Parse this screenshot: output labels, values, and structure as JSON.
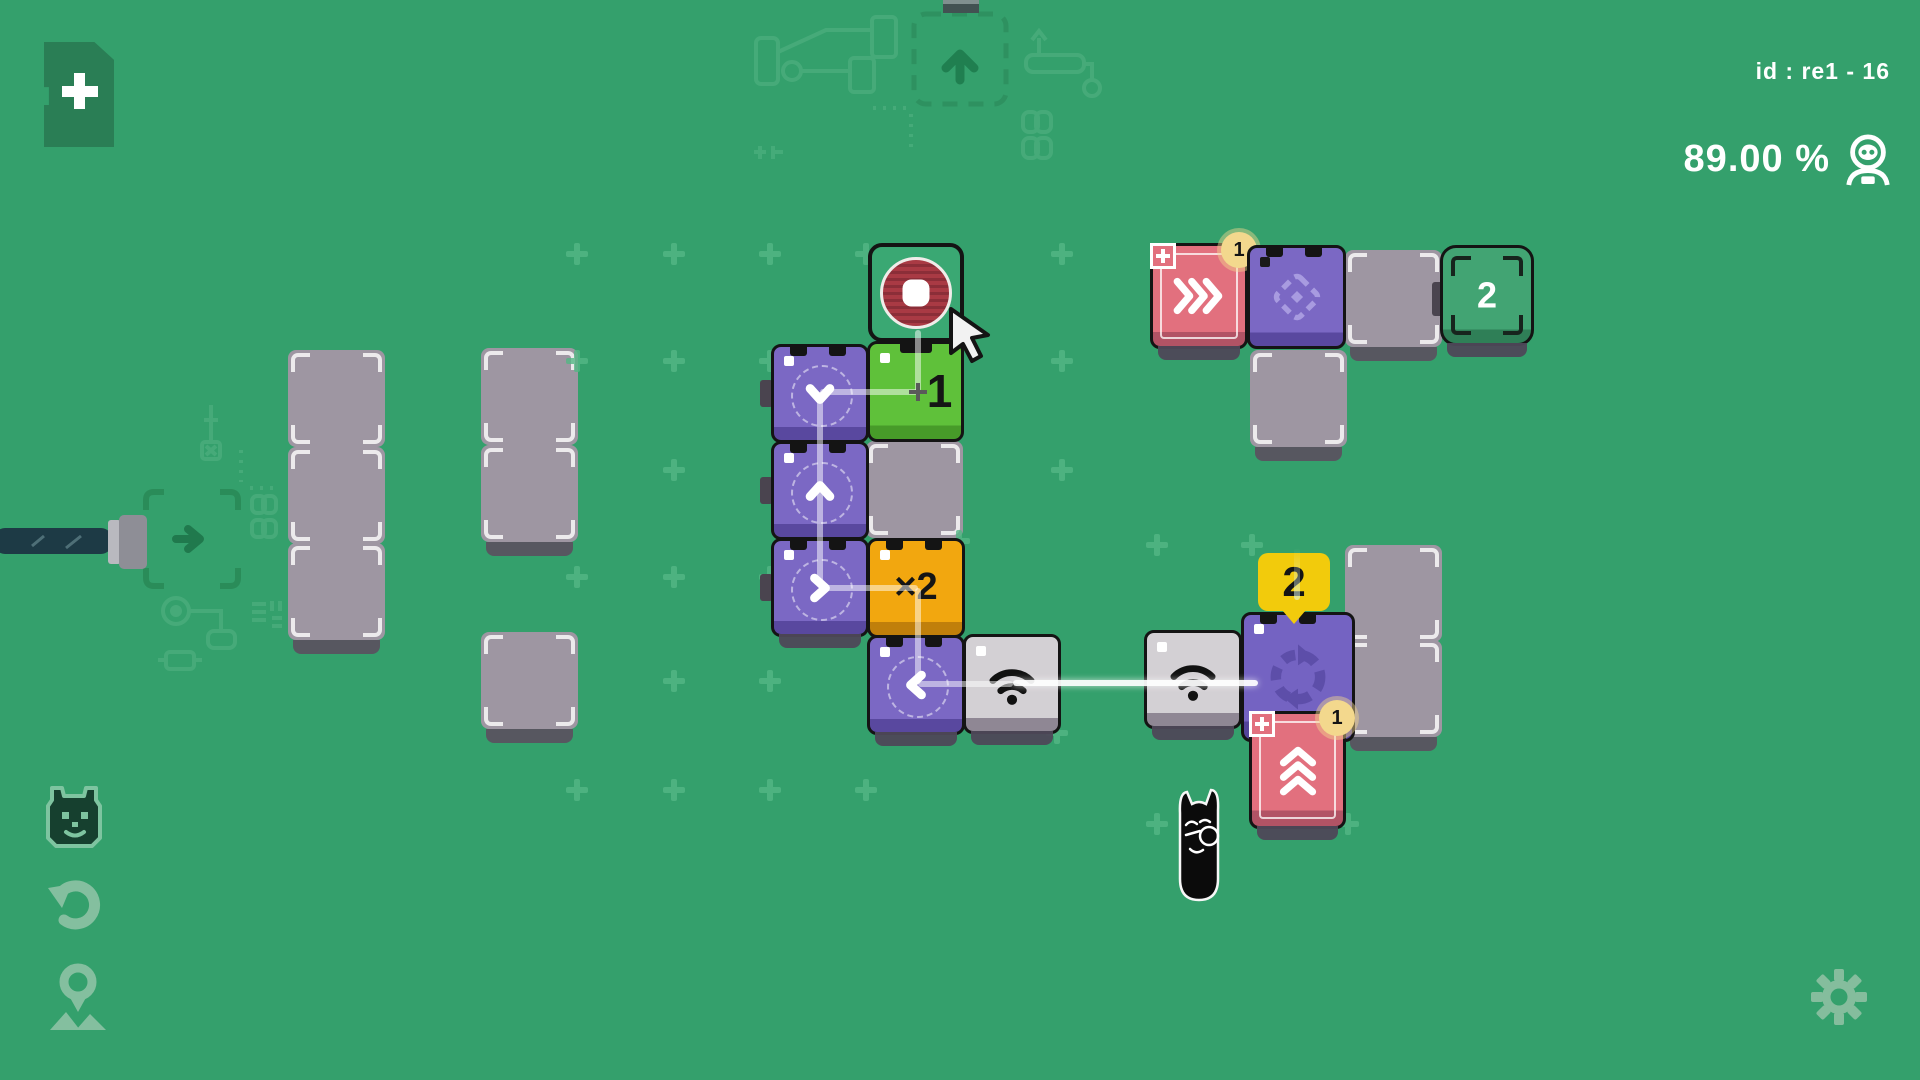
{
  "hud": {
    "level_id": "id : re1 - 16",
    "accuracy": "89.00 %",
    "icons": {
      "accuracy": "robot-head-icon",
      "add_card": "plus-card-icon",
      "settings": "gear-icon",
      "rail": [
        "cat-head-icon",
        "undo-icon",
        "location-pin-icon"
      ]
    }
  },
  "colors": {
    "background": "#34a06c",
    "pad": "#9e96a2",
    "purple": "#7b68c4",
    "green": "#5fc13a",
    "orange": "#f2a70f",
    "pink": "#e2707e",
    "light_gray": "#d3d0d4",
    "teal": "#42a473",
    "red_target": "#a93a44",
    "yellow_badge": "#f2cb0c",
    "line": "rgba(255,255,255,0.5)"
  },
  "board": {
    "pads": [
      {
        "name": "pad",
        "x": 288,
        "y": 350,
        "w": 97,
        "h": 97
      },
      {
        "name": "pad",
        "x": 288,
        "y": 447,
        "w": 97,
        "h": 97
      },
      {
        "name": "pad",
        "x": 288,
        "y": 543,
        "w": 97,
        "h": 97,
        "shadow": true
      },
      {
        "name": "pad",
        "x": 481,
        "y": 348,
        "w": 97,
        "h": 97
      },
      {
        "name": "pad",
        "x": 481,
        "y": 445,
        "w": 97,
        "h": 97,
        "shadow": true
      },
      {
        "name": "pad",
        "x": 481,
        "y": 632,
        "w": 97,
        "h": 97,
        "shadow": true
      },
      {
        "name": "pad",
        "x": 866,
        "y": 441,
        "w": 97,
        "h": 97
      },
      {
        "name": "pad",
        "x": 1345,
        "y": 250,
        "w": 97,
        "h": 97,
        "shadow": true
      },
      {
        "name": "pad",
        "x": 1250,
        "y": 350,
        "w": 97,
        "h": 97,
        "shadow": true
      },
      {
        "name": "pad",
        "x": 1345,
        "y": 545,
        "w": 97,
        "h": 97
      },
      {
        "name": "pad",
        "x": 1345,
        "y": 640,
        "w": 97,
        "h": 97,
        "shadow": true
      }
    ],
    "machines": [
      {
        "name": "goal-node-stop",
        "x": 868,
        "y": 243,
        "w": 96,
        "h": 99,
        "kind": "goal-red"
      },
      {
        "name": "node-battery-1",
        "x": 867,
        "y": 341,
        "w": 97,
        "h": 101,
        "color": "green",
        "label": "1",
        "label_size": 46,
        "label_dx": 24,
        "dot": "white",
        "notch_center": true
      },
      {
        "name": "node-arrow-down",
        "x": 771,
        "y": 344,
        "w": 98,
        "h": 99,
        "color": "purple",
        "icon": "chevron-down",
        "dashed": true,
        "notches": true,
        "dot": "white"
      },
      {
        "name": "node-arrow-up",
        "x": 771,
        "y": 441,
        "w": 98,
        "h": 99,
        "color": "purple",
        "icon": "chevron-up",
        "dashed": true,
        "notches": true,
        "dot": "white"
      },
      {
        "name": "node-arrow-right",
        "x": 771,
        "y": 538,
        "w": 98,
        "h": 99,
        "color": "purple",
        "icon": "chevron-right",
        "dashed": true,
        "notches": true,
        "dot": "white",
        "shadow": true
      },
      {
        "name": "node-multiply-x2",
        "x": 867,
        "y": 538,
        "w": 98,
        "h": 100,
        "color": "orange",
        "label": "×2",
        "label_size": 38,
        "notches": true,
        "dot": "white"
      },
      {
        "name": "node-arrow-left",
        "x": 867,
        "y": 635,
        "w": 98,
        "h": 100,
        "color": "purple",
        "icon": "chevron-left",
        "dashed": true,
        "notches": true,
        "dot": "white",
        "shadow": true
      },
      {
        "name": "node-wifi-left",
        "x": 963,
        "y": 634,
        "w": 98,
        "h": 100,
        "color": "lightgray",
        "icon": "wifi",
        "dot": "white",
        "shadow": true
      },
      {
        "name": "node-wifi-right",
        "x": 1144,
        "y": 630,
        "w": 98,
        "h": 99,
        "color": "lightgray",
        "icon": "wifi",
        "dot": "white",
        "shadow": true
      },
      {
        "name": "node-rotate",
        "x": 1241,
        "y": 612,
        "w": 114,
        "h": 130,
        "color": "purple2",
        "icon": "rotate",
        "dot": "white",
        "notches": true,
        "bubble": "2"
      },
      {
        "name": "node-boost-up",
        "x": 1249,
        "y": 711,
        "w": 97,
        "h": 118,
        "color": "pink",
        "icon": "triple-chevron-up",
        "frame": true,
        "badge_plus": true,
        "badge_count": "1",
        "shadow": true
      },
      {
        "name": "node-boost-right",
        "x": 1150,
        "y": 243,
        "w": 98,
        "h": 106,
        "color": "pink",
        "icon": "triple-chevron-right",
        "frame": true,
        "badge_plus": true,
        "badge_count": "1",
        "shadow": true
      },
      {
        "name": "node-diamond",
        "x": 1247,
        "y": 245,
        "w": 99,
        "h": 104,
        "color": "purple",
        "icon": "diamond",
        "dot": "black",
        "notches": true
      },
      {
        "name": "goal-node-2",
        "x": 1440,
        "y": 245,
        "w": 94,
        "h": 101,
        "kind": "goal-teal",
        "label": "2",
        "label_size": 36,
        "shadow": true
      }
    ],
    "lines": [
      {
        "x1": 820,
        "y1": 392,
        "x2": 820,
        "y2": 588
      },
      {
        "x1": 820,
        "y1": 392,
        "x2": 918,
        "y2": 392
      },
      {
        "x1": 918,
        "y1": 330,
        "x2": 918,
        "y2": 392
      },
      {
        "x1": 820,
        "y1": 588,
        "x2": 918,
        "y2": 588
      },
      {
        "x1": 918,
        "y1": 588,
        "x2": 918,
        "y2": 684
      },
      {
        "x1": 918,
        "y1": 684,
        "x2": 1013,
        "y2": 684
      },
      {
        "x1": 1013,
        "y1": 683,
        "x2": 1258,
        "y2": 683,
        "bright": true
      },
      {
        "x1": 1297,
        "y1": 548,
        "x2": 1297,
        "y2": 600,
        "fade": true
      }
    ],
    "junctions": [
      {
        "x": 918,
        "y": 392
      }
    ],
    "crosses": [
      [
        577,
        254
      ],
      [
        674,
        254
      ],
      [
        770,
        254
      ],
      [
        866,
        254
      ],
      [
        1062,
        254
      ],
      [
        577,
        361
      ],
      [
        674,
        361
      ],
      [
        770,
        361
      ],
      [
        1062,
        361
      ],
      [
        674,
        470
      ],
      [
        1062,
        470
      ],
      [
        577,
        577
      ],
      [
        674,
        577
      ],
      [
        770,
        577
      ],
      [
        959,
        541
      ],
      [
        1157,
        545
      ],
      [
        1252,
        545
      ],
      [
        674,
        681
      ],
      [
        770,
        681
      ],
      [
        577,
        790
      ],
      [
        674,
        790
      ],
      [
        770,
        790
      ],
      [
        866,
        790
      ],
      [
        1057,
        733
      ],
      [
        1255,
        733
      ],
      [
        1157,
        824
      ],
      [
        1348,
        824
      ]
    ],
    "nubs": [
      {
        "x": 760,
        "y": 380,
        "w": 13,
        "h": 27
      },
      {
        "x": 760,
        "y": 477,
        "w": 13,
        "h": 27
      },
      {
        "x": 760,
        "y": 574,
        "w": 13,
        "h": 27
      },
      {
        "x": 1432,
        "y": 282,
        "w": 14,
        "h": 34
      },
      {
        "x": 1230,
        "y": 656,
        "w": 18,
        "h": 42,
        "light": true
      }
    ]
  },
  "characters": {
    "cat": {
      "x": 1166,
      "y": 783,
      "name": "black-cat-character"
    }
  },
  "cursor": {
    "x": 948,
    "y": 306
  },
  "decorations": [
    "card-slot-tab",
    "upload-slot-outline",
    "robot-arm-outline",
    "router-outline",
    "chain-links",
    "screwdriver-outline",
    "start-node-outline",
    "power-cable",
    "circuit-nodes"
  ]
}
